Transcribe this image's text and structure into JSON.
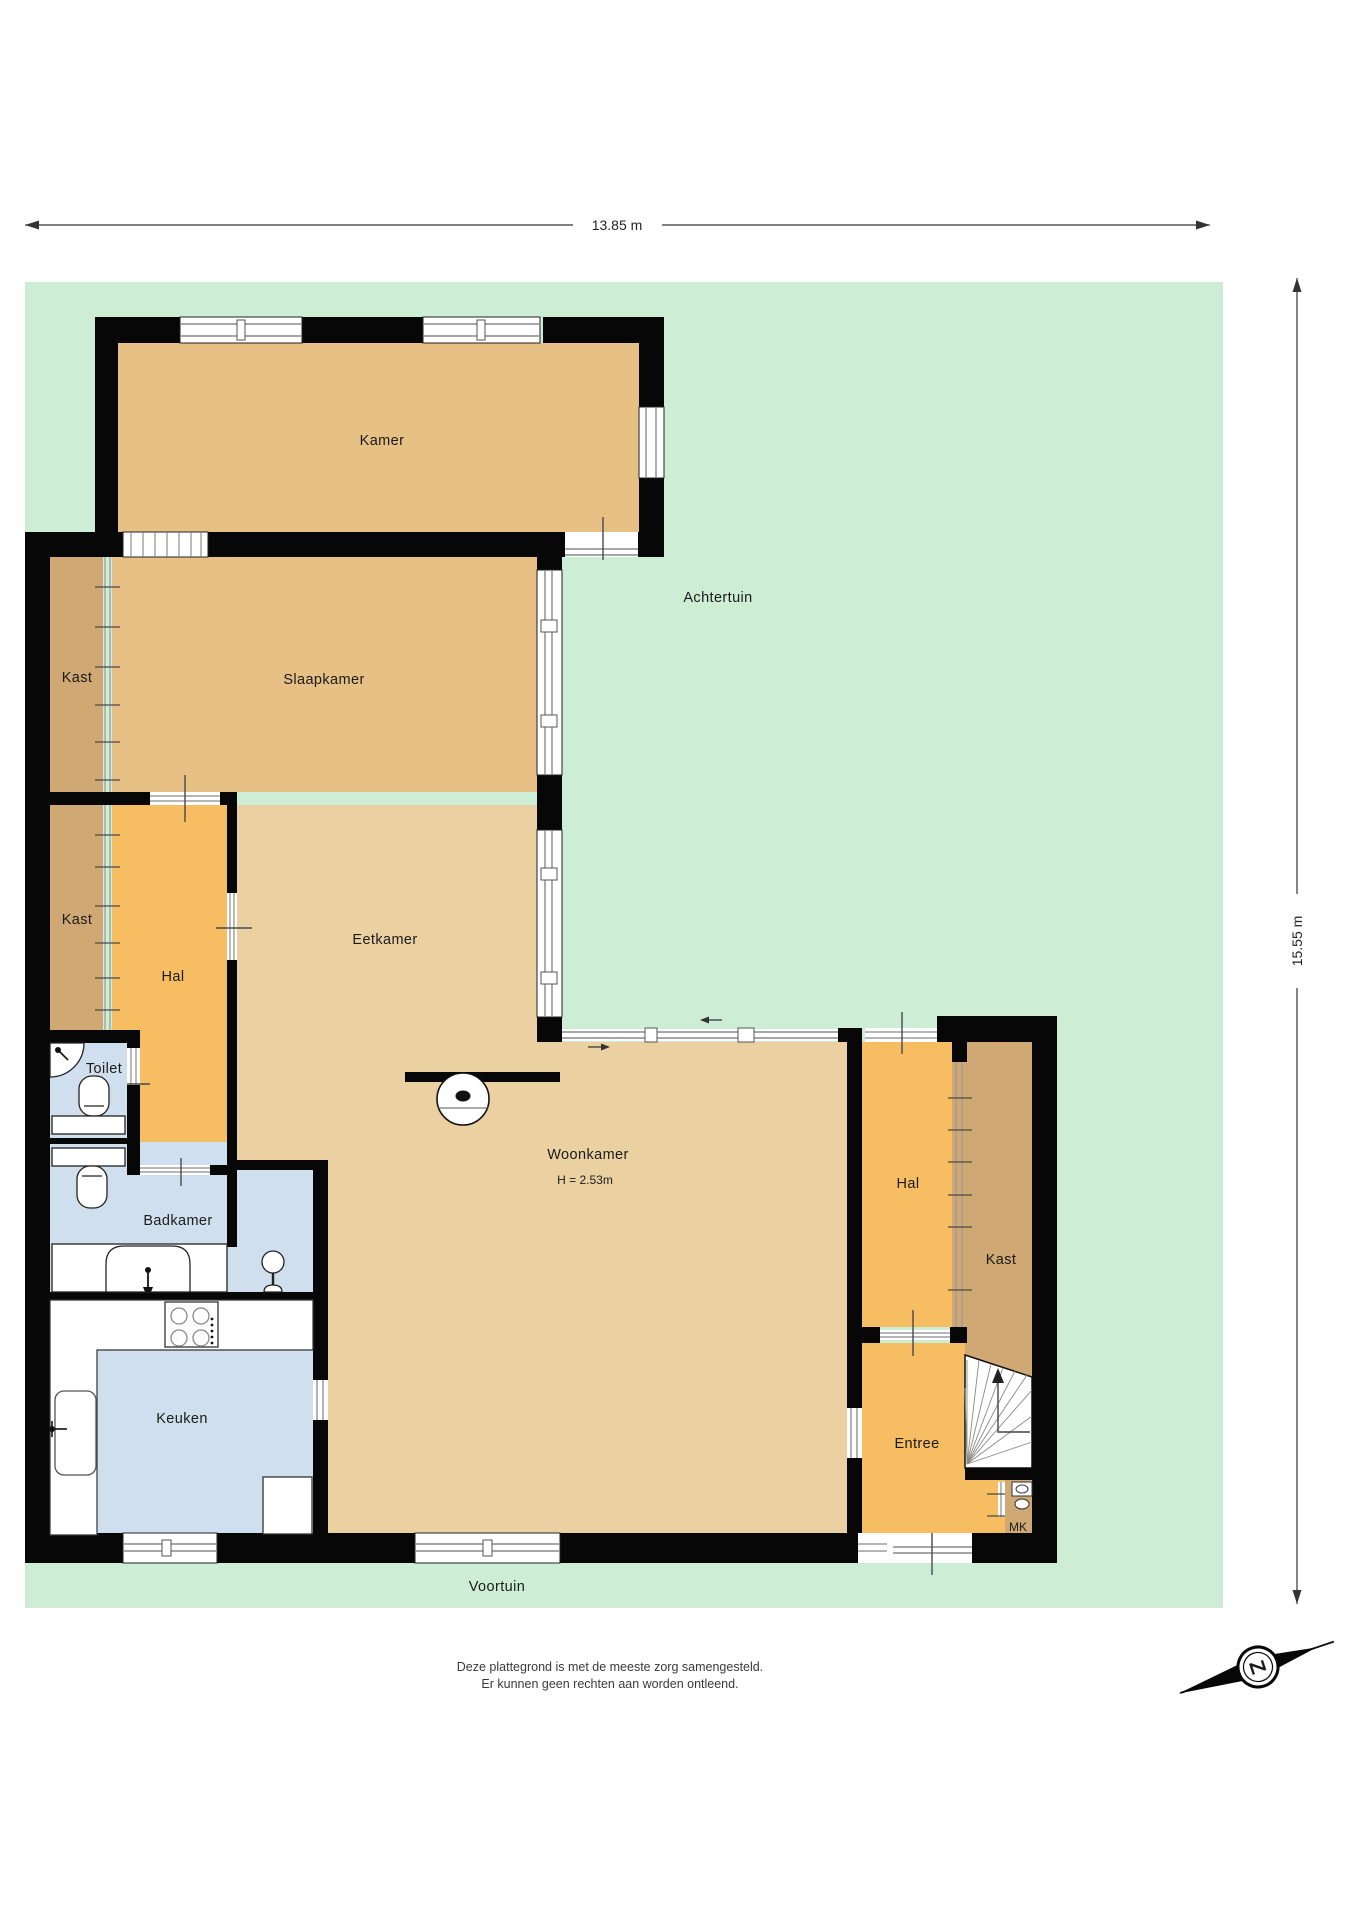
{
  "plan": {
    "dimensions": {
      "width_label": "13.85 m",
      "height_label": "15.55 m"
    },
    "gardens": {
      "back_garden": "Achtertuin",
      "front_garden": "Voortuin"
    },
    "rooms": {
      "kamer": "Kamer",
      "slaapkamer": "Slaapkamer",
      "kast_top": "Kast",
      "kast_left": "Kast",
      "hal_left": "Hal",
      "eetkamer": "Eetkamer",
      "toilet": "Toilet",
      "badkamer": "Badkamer",
      "keuken": "Keuken",
      "woonkamer": "Woonkamer",
      "woonkamer_height": "H = 2.53m",
      "hal_right": "Hal",
      "kast_right": "Kast",
      "entree": "Entree",
      "meterkast": "MK"
    },
    "compass": {
      "south_label": "Z"
    },
    "disclaimer": {
      "line1": "Deze plattegrond is met de meeste zorg samengesteld.",
      "line2": "Er kunnen geen rechten aan worden ontleend."
    },
    "colors": {
      "garden_green": "#cdedd5",
      "room_tan": "#e7c085",
      "room_light_tan": "#ebd1a2",
      "closet_brown": "#cfa873",
      "hall_orange": "#f6bd62",
      "wet_room_blue": "#cfdfee",
      "wall_black": "#070707"
    }
  }
}
